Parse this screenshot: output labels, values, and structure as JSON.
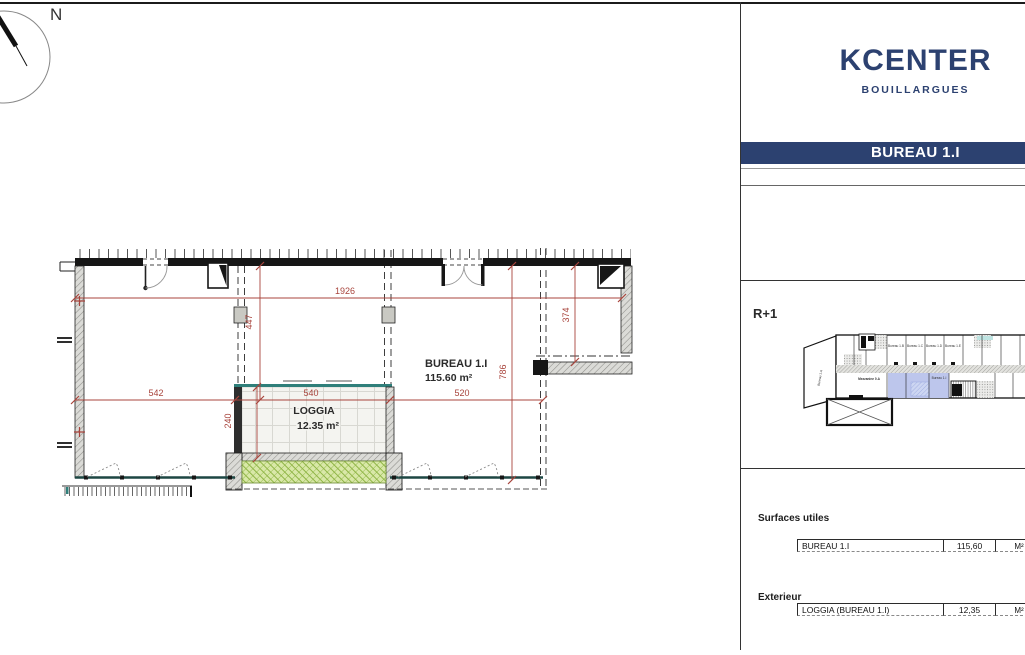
{
  "compass": {
    "north": "N"
  },
  "plan": {
    "room": {
      "name": "BUREAU 1.I",
      "area": "115.60 m²"
    },
    "loggia": {
      "name": "LOGGIA",
      "area": "12.35 m²"
    },
    "dimensions": {
      "overall_width": "1926",
      "bay_height": "447",
      "right_height": "374",
      "room_depth": "786",
      "left_width": "542",
      "loggia_width": "540",
      "right_width": "520",
      "loggia_depth": "240"
    }
  },
  "panel": {
    "brand": {
      "title": "KCENTER",
      "subtitle": "BOUILLARGUES"
    },
    "banner": "BUREAU 1.I",
    "keyplan": {
      "level": "R+1",
      "units": {
        "a": "Bureau 1.A",
        "b": "Bureau 1.B",
        "c": "Bureau 1.C",
        "d": "Bureau 1.D",
        "e": "Bureau 1.E",
        "f": "Bureau 1.F",
        "i": "Bureau 1.I",
        "m": "Bureau 1.M",
        "mezz": "Mezzanine 0.A"
      }
    },
    "surfaces": {
      "interior_title": "Surfaces utiles",
      "interior_rows": [
        {
          "name": "BUREAU 1.I",
          "value": "115,60",
          "unit": "M²"
        }
      ],
      "exterior_title": "Exterieur",
      "exterior_rows": [
        {
          "name": "LOGGIA (BUREAU 1.I)",
          "value": "12,35",
          "unit": "M²"
        }
      ]
    }
  },
  "colors": {
    "brand_navy": "#2c4170",
    "dimension_red": "#a8443c",
    "glazing_teal": "#2f7f7a",
    "planter_green": "#d9e8a8",
    "highlight_blue": "#bdc6ec"
  }
}
